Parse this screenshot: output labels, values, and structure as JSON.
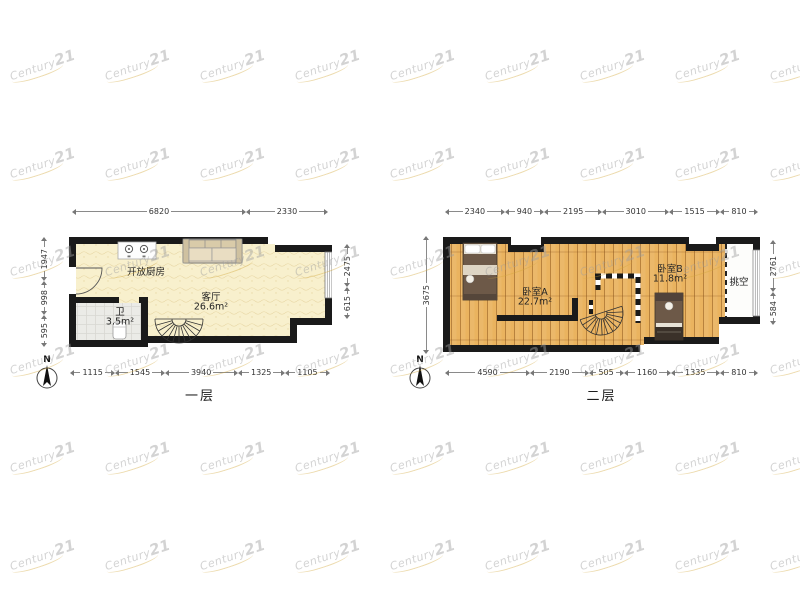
{
  "watermark": {
    "brand": "Century",
    "number": "21",
    "swoosh_color": "#d2a63a"
  },
  "colors": {
    "wall": "#1a1a1a",
    "floor1_tile": "#f8f0cd",
    "floor2_wood": "#eab35f",
    "bath_tile": "#ebebe7"
  },
  "floors": [
    {
      "name": "floor-1",
      "label": "一层",
      "compass": "N",
      "rooms": [
        {
          "name": "开放厨房",
          "area": ""
        },
        {
          "name": "客厅",
          "area": "26.6m²"
        },
        {
          "name": "卫",
          "area": "3.5m²"
        }
      ],
      "dimensions": {
        "top": [
          6820,
          2330
        ],
        "bottom": [
          1115,
          1545,
          3940,
          1325,
          1105
        ],
        "left": [
          1947,
          998,
          595
        ],
        "right": [
          2475,
          615
        ]
      }
    },
    {
      "name": "floor-2",
      "label": "二层",
      "compass": "N",
      "rooms": [
        {
          "name": "卧室A",
          "area": "22.7m²"
        },
        {
          "name": "卧室B",
          "area": "11.8m²"
        },
        {
          "name": "挑空",
          "area": ""
        }
      ],
      "dimensions": {
        "top": [
          2340,
          940,
          2195,
          3010,
          1515,
          810
        ],
        "bottom": [
          4590,
          2190,
          505,
          1160,
          1335,
          810
        ],
        "left": [
          3675
        ],
        "right": [
          2761,
          584
        ]
      }
    }
  ]
}
